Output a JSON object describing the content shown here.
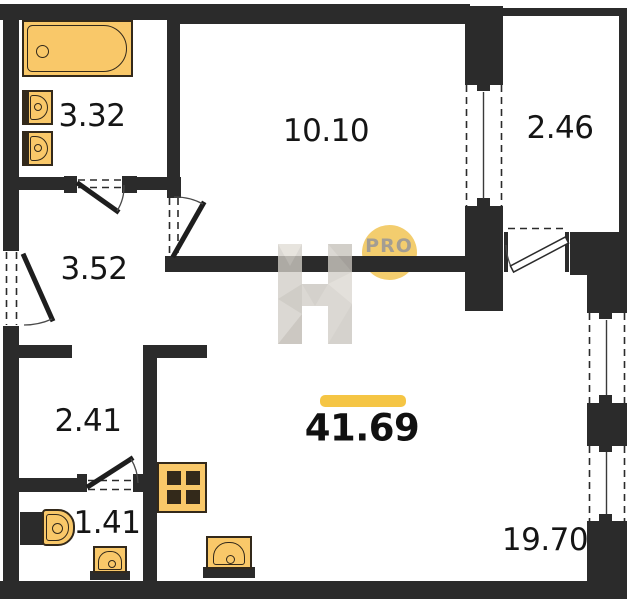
{
  "title": "Apartment floor plan",
  "watermark": {
    "letter": "H",
    "badge": "PRO"
  },
  "total_area_label": "41.69",
  "rooms": [
    {
      "name": "bathroom",
      "area": "3.32"
    },
    {
      "name": "bedroom",
      "area": "10.10"
    },
    {
      "name": "balcony",
      "area": "2.46"
    },
    {
      "name": "hallway",
      "area": "3.52"
    },
    {
      "name": "storage",
      "area": "2.41"
    },
    {
      "name": "wc",
      "area": "1.41"
    },
    {
      "name": "living-kitchen",
      "area": "19.70"
    }
  ],
  "colors": {
    "wall": "#2b2b2b",
    "fixture": "#F9C869",
    "fixline": "#33291a",
    "accent": "#F5C544",
    "badge": "#F2CA66"
  }
}
